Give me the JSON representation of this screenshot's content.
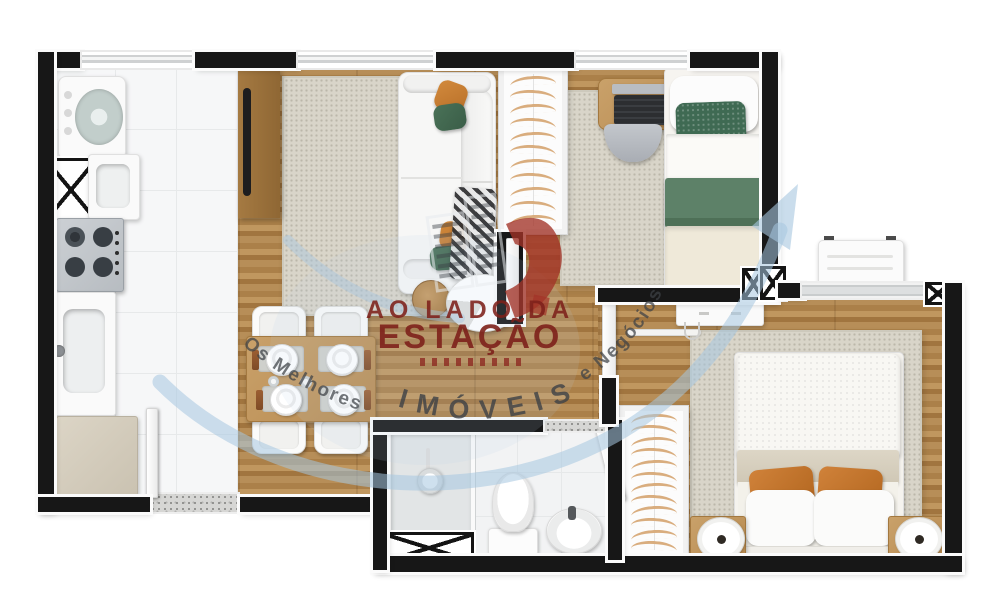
{
  "image": {
    "type": "3d-floor-plan-render",
    "description": "Top-down 3D architectural render of a small apartment: open kitchen and living/dining room, two bedrooms, one bathroom, two wardrobes, service shafts marked with X"
  },
  "watermark": {
    "top_line": "AO LADO DA",
    "main_line": "ESTAÇÃO",
    "bottom_curved": "IMÓVEIS",
    "left_curved": "Os Melhores",
    "right_curved": "e Negócios",
    "colors": {
      "text_red": "#7e211b",
      "swoosh_blue": "#a6c6e0",
      "curved_gray": "#3d4146",
      "logo_red": "#a23227"
    }
  },
  "palette": {
    "wall": "#171717",
    "wood_floor": "#b38a54",
    "kitchen_tile": "#f6f7f8",
    "rug": "#d9d5c9",
    "accent_orange": "#c8772f",
    "accent_green": "#3f6a53",
    "hanger": "#d9ad7e"
  },
  "closets": {
    "bedroom1_hangers": 11,
    "bedroom2_hangers": 12
  },
  "rooms": {
    "kitchen": [
      "washing-machine",
      "utility-shaft",
      "laundry-sink",
      "cooktop",
      "sink-counter",
      "base-cabinet",
      "entry-door",
      "entry-mat"
    ],
    "living_dining": [
      "tv-panel",
      "tv",
      "area-rug",
      "sofa",
      "throw-blanket",
      "coffee-table",
      "wood-stool",
      "dining-table",
      "dining-chairs",
      "plates"
    ],
    "bedroom1": [
      "wardrobe",
      "desk",
      "laptop",
      "desk-chair",
      "single-bed",
      "green-pillow",
      "green-blanket",
      "shaft-markers"
    ],
    "bedroom2": [
      "sideboard",
      "hook-rail",
      "wardrobe",
      "double-bed",
      "orange-pillows",
      "nightstands",
      "lamps",
      "window",
      "ac-condenser"
    ],
    "bathroom": [
      "shower-box",
      "shower-head",
      "utility-shaft",
      "toilet",
      "sink",
      "door-threshold"
    ]
  }
}
